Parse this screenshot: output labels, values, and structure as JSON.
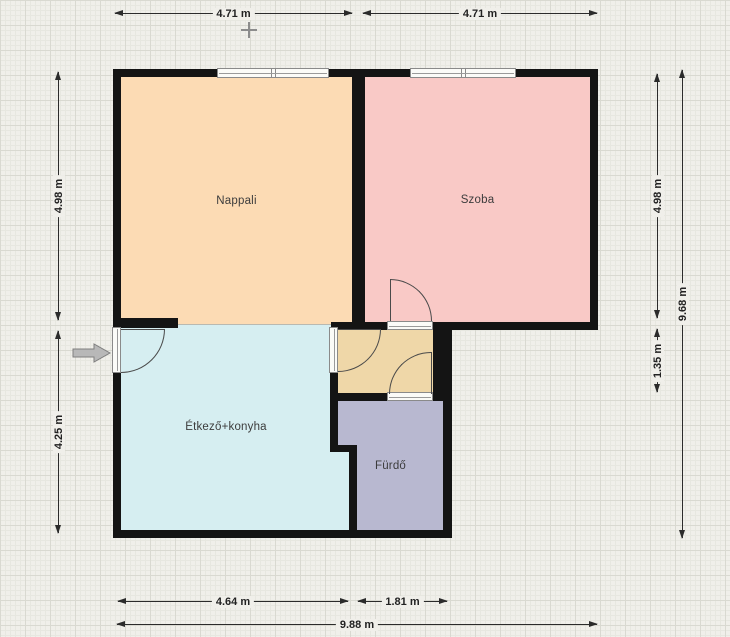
{
  "floor_plan": {
    "rooms": {
      "nappali": {
        "label": "Nappali",
        "fill": "#fcdbb4"
      },
      "szoba": {
        "label": "Szoba",
        "fill": "#f9c9c6"
      },
      "etkezo_konyha": {
        "label": "Étkező+konyha",
        "fill": "#d6eef1"
      },
      "furdo": {
        "label": "Fürdő",
        "fill": "#b8b8d0"
      },
      "hallway": {
        "label": "",
        "fill": "#efd7a8"
      }
    },
    "dimensions": {
      "top_left": "4.71 m",
      "top_right": "4.71 m",
      "left_upper": "4.98 m",
      "left_lower": "4.25 m",
      "right_upper": "4.98 m",
      "right_middle": "1.35 m",
      "right_overall": "9.68 m",
      "bottom_left": "4.64 m",
      "bottom_middle": "1.81 m",
      "bottom_overall": "9.88 m"
    },
    "colors": {
      "background": "#f0efea",
      "wall": "#141414",
      "dimension_line": "#2b2b2b",
      "door_swing": "#4a4a4a",
      "window_frame": "#8a8a8a",
      "entrance_arrow": "#b8b8b8"
    },
    "icons": {
      "entrance_arrow": "right-arrow",
      "origin_marker": "crosshair"
    }
  }
}
